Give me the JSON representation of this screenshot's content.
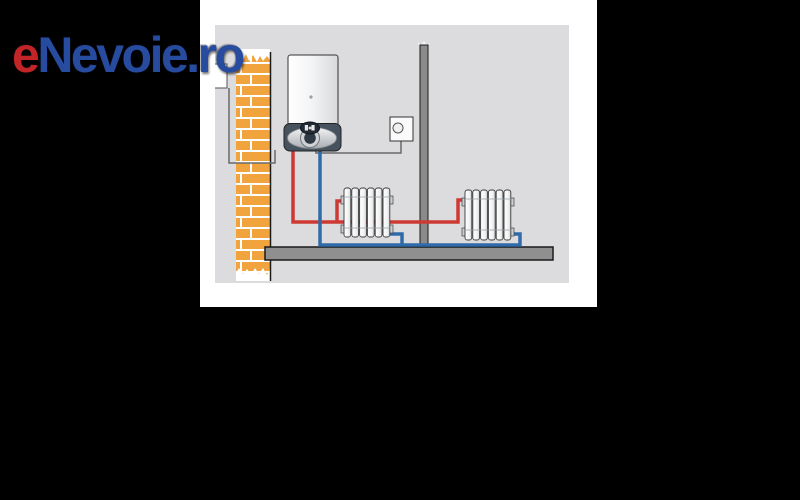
{
  "window": {
    "background": "#000000"
  },
  "canvas": {
    "background": "#ffffff"
  },
  "logo": {
    "prefix": "e",
    "rest": "Nevoie.ro",
    "prefix_color": "#c22528",
    "rest_color": "#274b9f"
  },
  "diagram": {
    "background": "#dcdcde",
    "colors": {
      "supply_pipe_red": "#cd3a34",
      "return_pipe_blue": "#2e6ba8",
      "brick_orange": "#f1a43e",
      "mortar_white": "#ffffff",
      "floor_gray": "#8f8f8f",
      "partition_gray": "#8b8b8b",
      "boiler_base_dark": "#46535f",
      "wire_gray": "#6a6a6a"
    },
    "components": [
      {
        "name": "brick-chimney-wall"
      },
      {
        "name": "flue-outlet"
      },
      {
        "name": "wall-mounted-boiler"
      },
      {
        "name": "circulation-pump"
      },
      {
        "name": "room-thermostat"
      },
      {
        "name": "thermostat-wire"
      },
      {
        "name": "partition-wall"
      },
      {
        "name": "floor-slab"
      },
      {
        "name": "radiator-1"
      },
      {
        "name": "radiator-2"
      },
      {
        "name": "hot-water-supply-pipe"
      },
      {
        "name": "cold-water-return-pipe"
      }
    ]
  }
}
